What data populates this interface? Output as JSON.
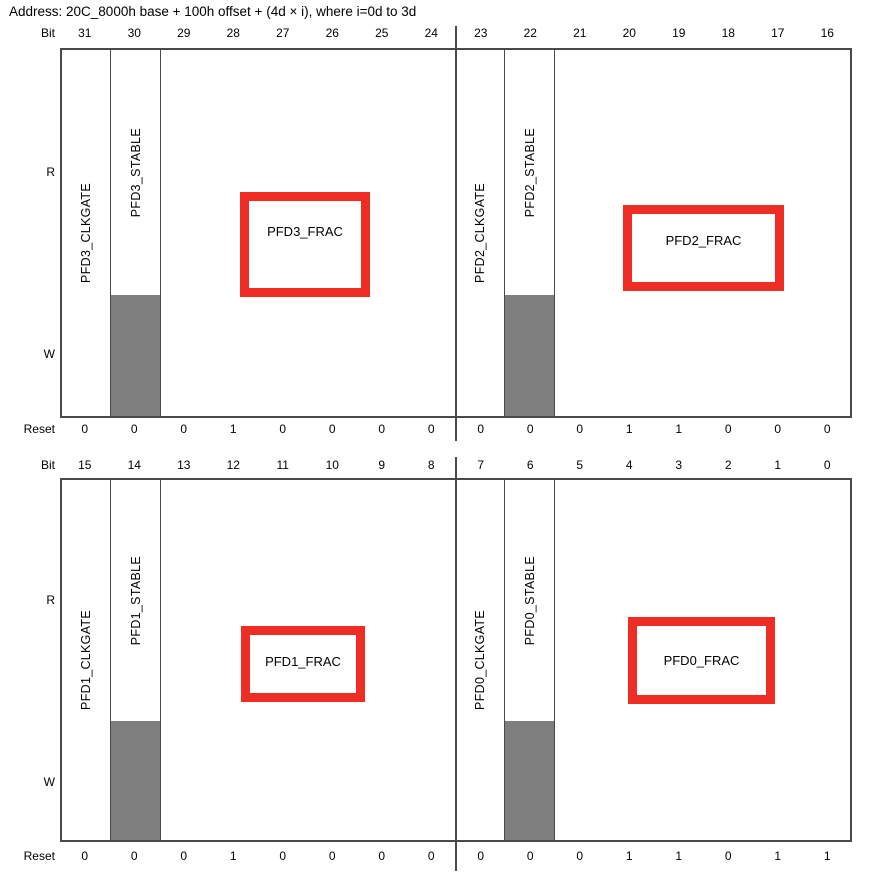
{
  "address_line": "Address: 20C_8000h base + 100h offset + (4d × i), where i=0d to 3d",
  "labels": {
    "bit": "Bit",
    "reset": "Reset",
    "read": "R",
    "write": "W"
  },
  "colors": {
    "red_box": "#ee2e24",
    "gray_fill": "#7e7e7e",
    "line": "#4a4a4a"
  },
  "upper_register": {
    "bit_numbers": [
      "31",
      "30",
      "29",
      "28",
      "27",
      "26",
      "25",
      "24",
      "23",
      "22",
      "21",
      "20",
      "19",
      "18",
      "17",
      "16"
    ],
    "reset_values": [
      "0",
      "0",
      "0",
      "1",
      "0",
      "0",
      "0",
      "0",
      "0",
      "0",
      "0",
      "1",
      "1",
      "0",
      "0",
      "0"
    ],
    "left_half": {
      "clkgate_field": "PFD3_CLKGATE",
      "stable_field": "PFD3_STABLE",
      "frac_field": "PFD3_FRAC"
    },
    "right_half": {
      "clkgate_field": "PFD2_CLKGATE",
      "stable_field": "PFD2_STABLE",
      "frac_field": "PFD2_FRAC"
    }
  },
  "lower_register": {
    "bit_numbers": [
      "15",
      "14",
      "13",
      "12",
      "11",
      "10",
      "9",
      "8",
      "7",
      "6",
      "5",
      "4",
      "3",
      "2",
      "1",
      "0"
    ],
    "reset_values": [
      "0",
      "0",
      "0",
      "1",
      "0",
      "0",
      "0",
      "0",
      "0",
      "0",
      "0",
      "1",
      "1",
      "0",
      "1",
      "1"
    ],
    "left_half": {
      "clkgate_field": "PFD1_CLKGATE",
      "stable_field": "PFD1_STABLE",
      "frac_field": "PFD1_FRAC"
    },
    "right_half": {
      "clkgate_field": "PFD0_CLKGATE",
      "stable_field": "PFD0_STABLE",
      "frac_field": "PFD0_FRAC"
    }
  }
}
